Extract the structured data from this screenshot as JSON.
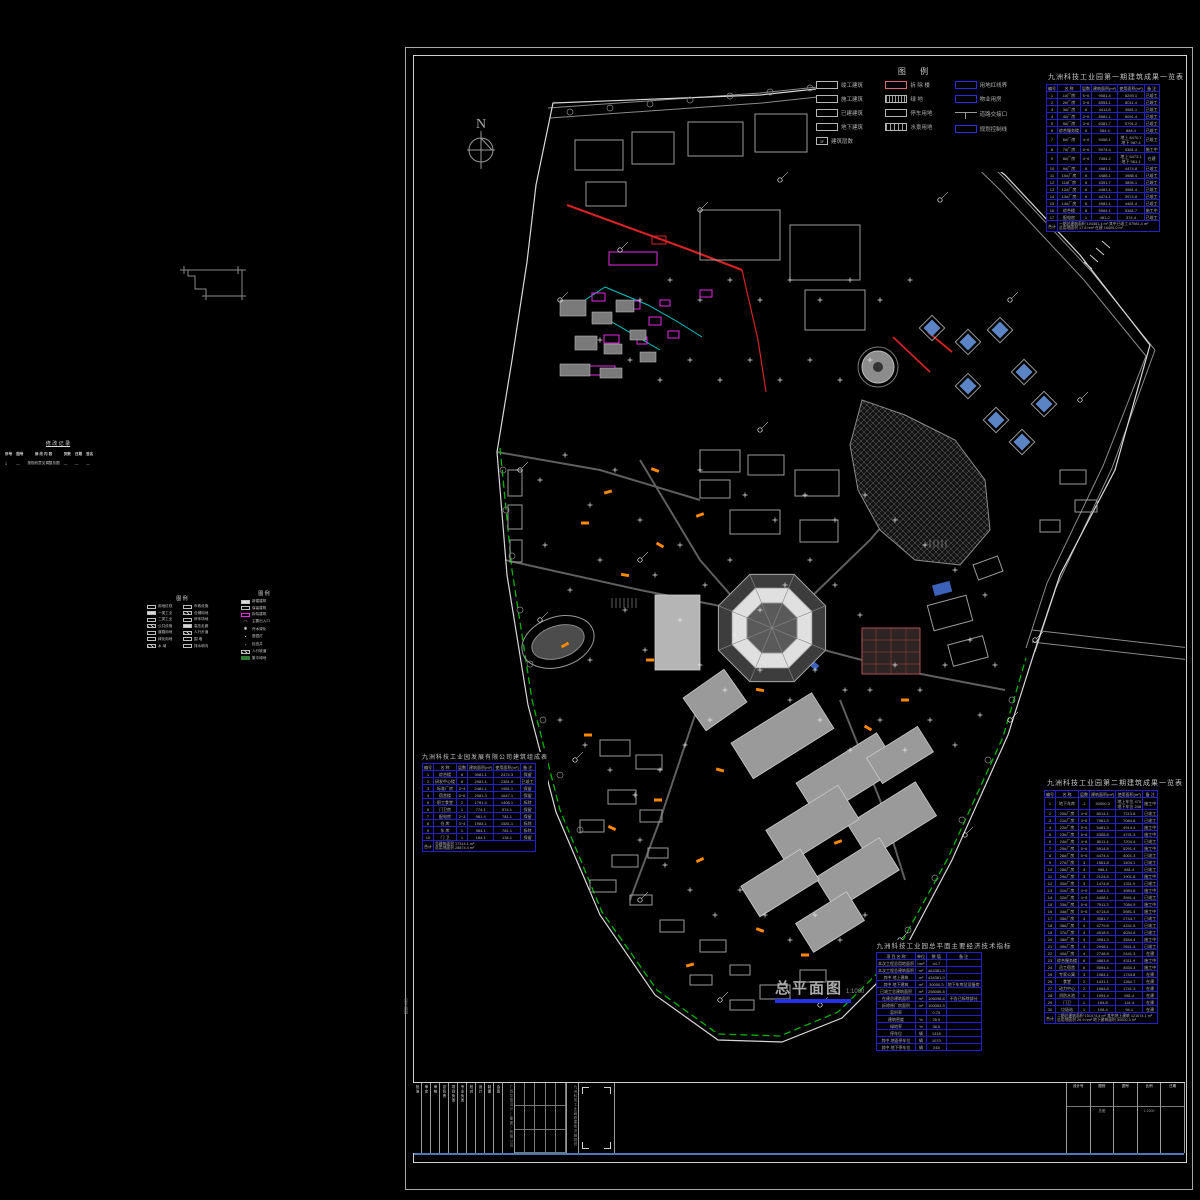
{
  "north": {
    "label": "N"
  },
  "plan_title": {
    "text": "总平面图",
    "scale": "1:1000"
  },
  "frame": {
    "edge_note": "总平面图"
  },
  "legend_main": {
    "title": "图    例",
    "col1": [
      {
        "label": "竣工建筑"
      },
      {
        "label": "施工建筑"
      },
      {
        "label": "已建建筑"
      },
      {
        "label": "地下建筑"
      },
      {
        "swatch_text": "3F",
        "label": "建筑层数"
      }
    ],
    "col2": [
      {
        "label": "拆 除 楼"
      },
      {
        "label": "绿    地"
      },
      {
        "label": "停车用地"
      },
      {
        "label": "水景用地"
      }
    ],
    "col3": [
      {
        "label": "用地红线界"
      },
      {
        "label": "物业用房"
      },
      {
        "label": "道路交接口"
      },
      {
        "label": "规划控制线"
      }
    ]
  },
  "tables": {
    "phase1": {
      "title": "九洲科技工业园第一期建筑成果一览表",
      "headers": [
        "编号",
        "名 称",
        "层数",
        "建筑面积(m²)",
        "使用面积(m²)",
        "备 注"
      ],
      "rows": [
        [
          "1",
          "1#厂房",
          "5~6",
          "9081.4",
          "8293.1",
          "已竣工"
        ],
        [
          "2",
          "2#厂房",
          "3~6",
          "8954.1",
          "8011.4",
          "已竣工"
        ],
        [
          "3",
          "3#厂房",
          "6",
          "4411.8",
          "3981.1",
          "已竣工"
        ],
        [
          "4",
          "4#厂房",
          "3~6",
          "8981.1",
          "8091.4",
          "已竣工"
        ],
        [
          "5",
          "5#厂房",
          "3~6",
          "6381.7",
          "5791.2",
          "已竣工"
        ],
        [
          "6",
          "综合服务楼",
          "6",
          "984.4",
          "884.4",
          "已竣工"
        ],
        [
          "7",
          "6#厂房",
          "4~6",
          "9458.1",
          "地上 8470.7\n地下 987.4",
          "已竣工"
        ],
        [
          "8",
          "7#厂房",
          "5~6",
          "5974.4",
          "5381.4",
          "施工中"
        ],
        [
          "9",
          "8#厂房",
          "4~6",
          "7454.2",
          "地上 6473.1\n地下 981.1",
          "在建"
        ],
        [
          "10",
          "9#厂房",
          "6",
          "4981.1",
          "4474.8",
          "已竣工"
        ],
        [
          "11",
          "10#厂房",
          "6",
          "4488.1",
          "3988.4",
          "已竣工"
        ],
        [
          "12",
          "11#厂房",
          "6",
          "4391.7",
          "3894.1",
          "已竣工"
        ],
        [
          "13",
          "12#厂房",
          "6",
          "4481.1",
          "3981.4",
          "已竣工"
        ],
        [
          "14",
          "13#厂房",
          "6",
          "4474.1",
          "3974.8",
          "已竣工"
        ],
        [
          "15",
          "14#厂房",
          "6",
          "4981.1",
          "4481.4",
          "已竣工"
        ],
        [
          "16",
          "综合楼",
          "8",
          "5984.1",
          "5381.7",
          "施工中"
        ],
        [
          "17",
          "配电房",
          "1",
          "481.2",
          "374.4",
          "已竣工"
        ]
      ],
      "footer_label": "合计",
      "footer": "一期总建筑面积 104381.4 m²  其中已竣工 87981.4 m²\n总用地面积 17.8 hm²  在建 16400.0 m²"
    },
    "phase2": {
      "title": "九洲科技工业园第二期建筑成果一览表",
      "headers": [
        "编号",
        "名 称",
        "层数",
        "建筑面积(m²)",
        "使用面积(m²)",
        "备 注"
      ],
      "rows": [
        [
          "1",
          "地下车库",
          "-1",
          "30000.3",
          "地上车位 470\n地下车位 248",
          "施工中"
        ],
        [
          "2",
          "20#厂房",
          "4~6",
          "8014.1",
          "7213.8",
          "已竣工"
        ],
        [
          "3",
          "21#厂房",
          "4~6",
          "7981.9",
          "7084.8",
          "已竣工"
        ],
        [
          "4",
          "22#厂房",
          "5~6",
          "5481.3",
          "4914.4",
          "施工中"
        ],
        [
          "5",
          "23#厂房",
          "5~6",
          "5308.8",
          "4791.3",
          "施工中"
        ],
        [
          "6",
          "24#厂房",
          "4~6",
          "8011.4",
          "7204.4",
          "已竣工"
        ],
        [
          "7",
          "25#厂房",
          "5~6",
          "5914.8",
          "5291.4",
          "施工中"
        ],
        [
          "8",
          "26#厂房",
          "5~6",
          "4474.4",
          "4001.3",
          "已竣工"
        ],
        [
          "9",
          "27#厂房",
          "3",
          "1581.8",
          "1404.1",
          "已竣工"
        ],
        [
          "10",
          "28#厂房",
          "3",
          "988.1",
          "881.4",
          "已竣工"
        ],
        [
          "11",
          "29#厂房",
          "3",
          "2124.5",
          "1901.8",
          "施工中"
        ],
        [
          "12",
          "30#厂房",
          "3",
          "1474.8",
          "1311.9",
          "已竣工"
        ],
        [
          "13",
          "31#厂房",
          "4~5",
          "4481.3",
          "3984.8",
          "施工中"
        ],
        [
          "14",
          "32#厂房",
          "4~5",
          "4408.1",
          "3941.4",
          "已竣工"
        ],
        [
          "15",
          "33#厂房",
          "5~6",
          "7911.3",
          "7084.9",
          "施工中"
        ],
        [
          "16",
          "34#厂房",
          "5~6",
          "6714.8",
          "5981.4",
          "施工中"
        ],
        [
          "17",
          "35#厂房",
          "4",
          "3081.7",
          "2744.7",
          "已竣工"
        ],
        [
          "18",
          "36#厂房",
          "4",
          "4779.8",
          "4241.5",
          "已竣工"
        ],
        [
          "19",
          "37#厂房",
          "4",
          "4518.9",
          "4034.8",
          "已竣工"
        ],
        [
          "20",
          "38#厂房",
          "4",
          "3981.3",
          "3544.4",
          "施工中"
        ],
        [
          "21",
          "39#厂房",
          "4",
          "2948.1",
          "2611.4",
          "已竣工"
        ],
        [
          "22",
          "40#厂房",
          "4",
          "2748.8",
          "2441.3",
          "在建"
        ],
        [
          "23",
          "综合服务楼",
          "8",
          "4881.8",
          "4311.9",
          "施工中"
        ],
        [
          "24",
          "员工宿舍",
          "6",
          "5094.4",
          "4534.3",
          "施工中"
        ],
        [
          "25",
          "专家公寓",
          "3",
          "1984.1",
          "1744.8",
          "在建"
        ],
        [
          "26",
          "食堂",
          "2",
          "1431.1",
          "1264.7",
          "在建"
        ],
        [
          "27",
          "动力中心",
          "2",
          "1984.8",
          "1741.3",
          "在建"
        ],
        [
          "28",
          "消防水池",
          "1",
          "1094.4",
          "981.4",
          "在建"
        ],
        [
          "29",
          "门卫",
          "1",
          "184.8",
          "141.4",
          "在建"
        ],
        [
          "30",
          "垃圾站",
          "1",
          "108.4",
          "94.1",
          "在建"
        ]
      ],
      "footer_label": "合计",
      "footer": "二期总建筑面积 151074.4 m²  其中地上建筑 121074.1 m²\n总用地面积 26.9 hm²  地下建筑面积 30000.3 m²"
    },
    "company": {
      "title": "九洲科技工业园发展有限公司建筑组成表",
      "headers": [
        "编号",
        "名 称",
        "层数",
        "建筑面积(m²)",
        "使用面积(m²)",
        "备 注"
      ],
      "rows": [
        [
          "1",
          "综合楼",
          "6",
          "3081.1",
          "2474.3",
          "保留"
        ],
        [
          "2",
          "研发中心楼",
          "8",
          "2981.1",
          "2381.9",
          "已竣工"
        ],
        [
          "3",
          "标准厂房",
          "3~4",
          "2481.1",
          "1981.1",
          "保留"
        ],
        [
          "4",
          "宿舍楼",
          "5~6",
          "2081.3",
          "1647.1",
          "保留"
        ],
        [
          "5",
          "职工食堂",
          "2",
          "1781.4",
          "1408.1",
          "拆除"
        ],
        [
          "6",
          "门卫房",
          "1",
          "774.1",
          "574.1",
          "保留"
        ],
        [
          "7",
          "配电房",
          "2~3",
          "981.4",
          "781.1",
          "保留"
        ],
        [
          "8",
          "仓 库",
          "3~4",
          "1984.1",
          "1581.1",
          "拆除"
        ],
        [
          "9",
          "车 库",
          "1",
          "984.1",
          "781.1",
          "拆除"
        ],
        [
          "10",
          "门  卫",
          "1",
          "184.1",
          "134.1",
          "保留"
        ]
      ],
      "footer_label": "合计",
      "footer": "总建筑面积 17314.1 m²\n总用地面积 28874.4 m²"
    },
    "indicators": {
      "title": "九洲科技工业园总平面主要经济技术指标",
      "headers": [
        "项 目 名 称",
        "单位",
        "数 值",
        "备  注"
      ],
      "rows": [
        [
          "本次工程总用地面积",
          "hm²",
          "44.7",
          ""
        ],
        [
          "本次工程总建筑面积",
          "m²",
          "464381.3",
          ""
        ],
        [
          "其中  地上建筑",
          "m²",
          "434381.0",
          ""
        ],
        [
          "其中  地下建筑",
          "m²",
          "30000.3",
          "地下车库及设备房"
        ],
        [
          "已竣工总建筑面积",
          "m²",
          "258086.8",
          ""
        ],
        [
          "在建总建筑面积",
          "m²",
          "106098.8",
          "不含已拆除部分"
        ],
        [
          "拆除原厂房面积",
          "m²",
          "100063.9",
          ""
        ],
        [
          "容积率",
          "",
          "0.79",
          ""
        ],
        [
          "建筑密度",
          "%",
          "25.9",
          ""
        ],
        [
          "绿地率",
          "%",
          "38.5",
          ""
        ],
        [
          "停车位",
          "辆",
          "1318",
          ""
        ],
        [
          "其中  地面停车位",
          "辆",
          "1070",
          ""
        ],
        [
          "其中  地下停车位",
          "辆",
          "248",
          ""
        ]
      ]
    },
    "revision": {
      "title": "修 改 记 录",
      "headers": [
        "序号",
        "图号",
        "修 改 内 容",
        "页数",
        "日期",
        "签名"
      ],
      "rows": [
        [
          "1",
          "—",
          "按规划意见调整总图",
          "—",
          "—",
          "—"
        ],
        [
          "",
          "",
          "",
          "",
          "",
          ""
        ]
      ]
    }
  },
  "left_legend_a": {
    "title": "图  例",
    "rows": [
      [
        "wout",
        "用地红线",
        "wout",
        "市政设施"
      ],
      [
        "wfill",
        "一类工业",
        "hatch",
        "仓储用地"
      ],
      [
        "wout",
        "二类工业",
        "wout",
        "停车场地"
      ],
      [
        "hatch",
        "公共设施",
        "wfill",
        "高压走廊"
      ],
      [
        "wout",
        "道路用地",
        "hatch",
        "人行步道"
      ],
      [
        "wout",
        "绿化用地",
        "wout",
        "围  墙"
      ],
      [
        "hatch",
        "水  域",
        "wout",
        "排水明沟"
      ]
    ]
  },
  "left_legend_b": {
    "title": "图  例",
    "items": [
      {
        "sw": "wfill",
        "label": "新建建筑"
      },
      {
        "sw": "wout",
        "label": "保留建筑"
      },
      {
        "sw": "mag",
        "label": "拆除建筑"
      },
      {
        "sw": "glyph:◠",
        "label": "主要出入口"
      },
      {
        "sw": "glyph:✱",
        "label": "乔木绿化"
      },
      {
        "sw": "glyph:•",
        "label": "庭园灯"
      },
      {
        "sw": "glyph:▫",
        "label": "检查井"
      },
      {
        "sw": "hatch",
        "label": "人行坡道"
      },
      {
        "sw": "gfill",
        "label": "集中绿地"
      }
    ]
  },
  "titleblock": {
    "labels": [
      "批准",
      "审定",
      "审核",
      "总负责",
      "项目负责",
      "专业负责",
      "校对",
      "设计",
      "制图",
      "会签"
    ],
    "company": "广西华蓝设计(集团)有限公司",
    "project": "九洲科技工业园修建性详细规划",
    "fields": [
      {
        "label": "设计号",
        "value": ""
      },
      {
        "label": "图别",
        "value": "总图"
      },
      {
        "label": "图号",
        "value": ""
      },
      {
        "label": "比例",
        "value": "1:1000"
      },
      {
        "label": "日期",
        "value": ""
      }
    ]
  }
}
